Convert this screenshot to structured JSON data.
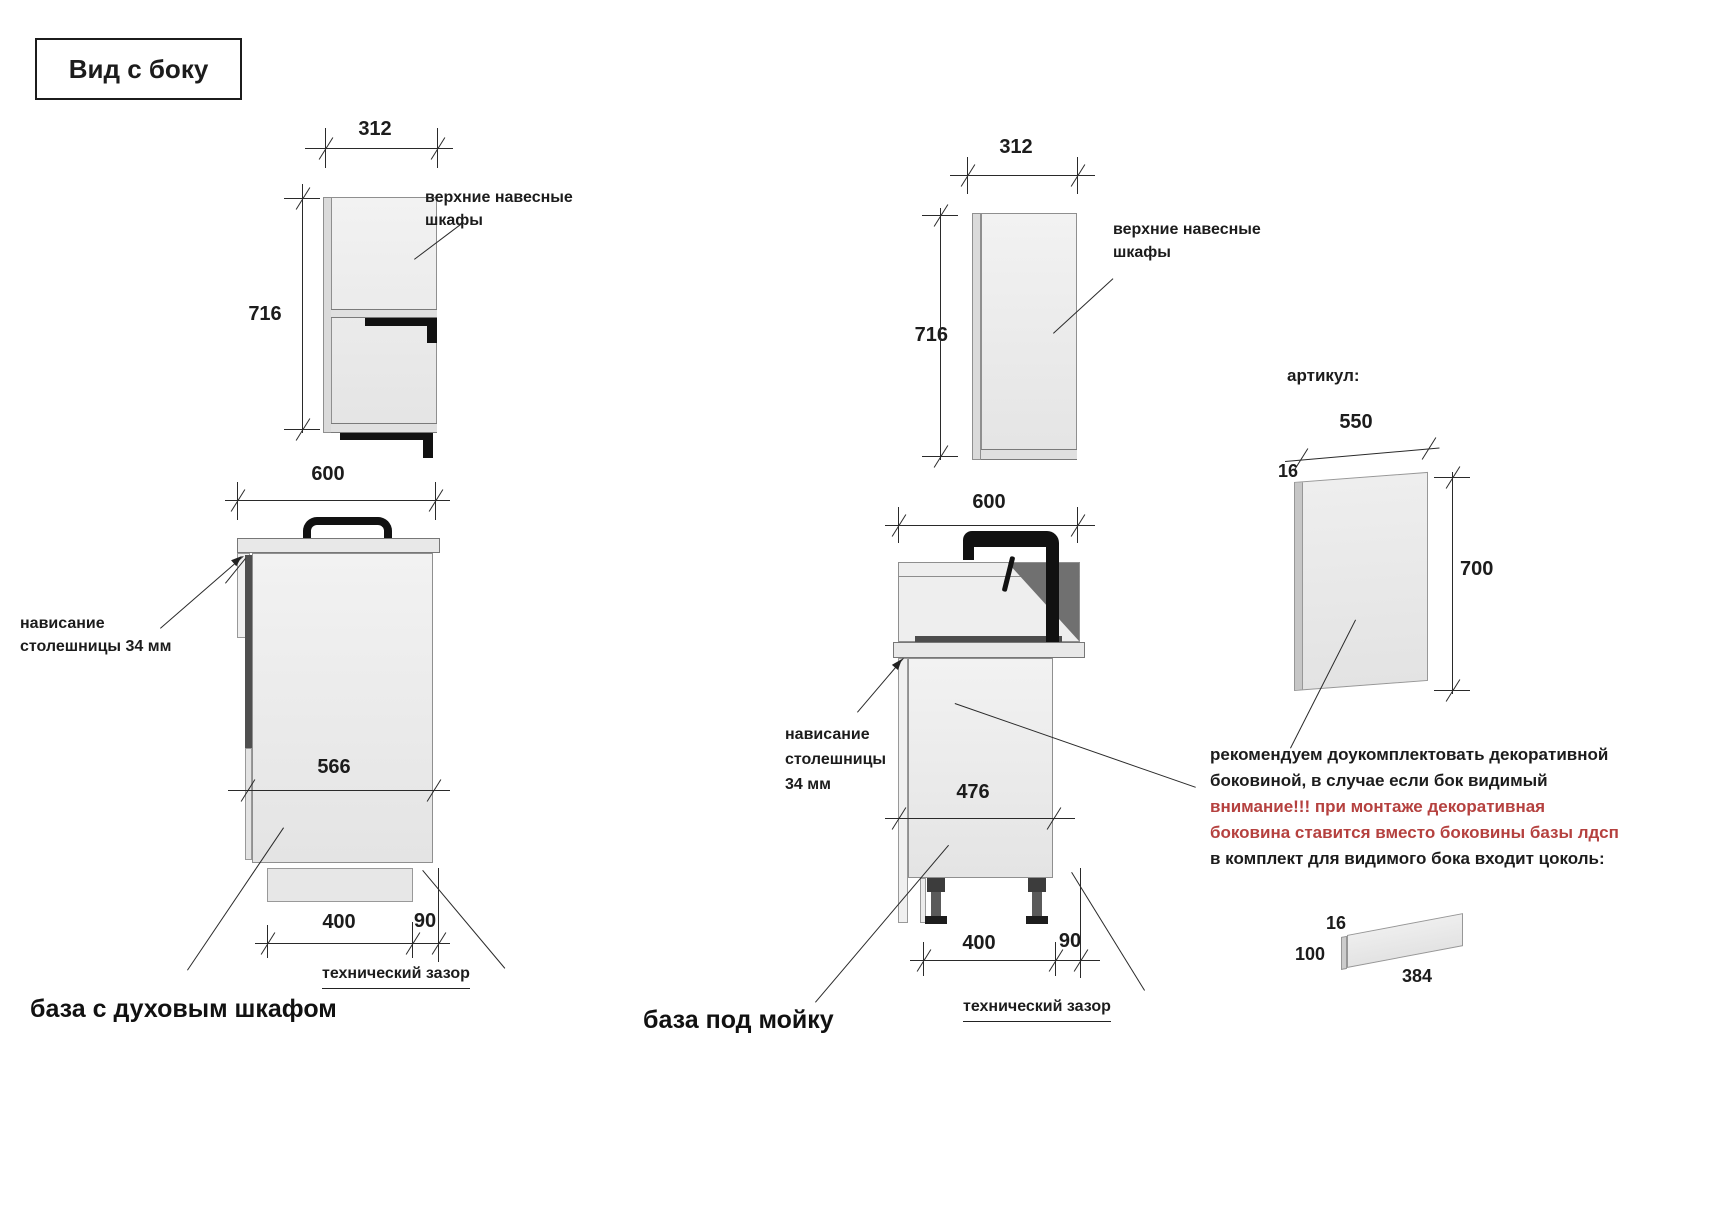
{
  "title": "Вид с боку",
  "annotations": {
    "upper_cabinets_line1": "верхние навесные",
    "upper_cabinets_line2": "шкафы",
    "overhang_line1": "нависание",
    "overhang_line2": "столешницы 34 мм",
    "overhang_mid_line1": "нависание",
    "overhang_mid_line2": "столешницы",
    "overhang_mid_line3": "34 мм",
    "tech_gap": "технический зазор",
    "articul": "артикул:"
  },
  "oven_unit": {
    "label": "база с духовым шкафом",
    "upper_width": "312",
    "upper_height": "716",
    "base_width": "600",
    "base_depth": "566",
    "plinth_depth": "400",
    "back_gap": "90"
  },
  "sink_unit": {
    "label": "база под мойку",
    "upper_width": "312",
    "upper_height": "716",
    "base_width": "600",
    "base_depth": "476",
    "plinth_depth": "400",
    "back_gap": "90"
  },
  "decor_panel": {
    "width": "550",
    "thickness": "16",
    "height": "700",
    "note_black_1": "рекомендуем доукомплектовать декоративной",
    "note_black_2": "боковиной, в случае если бок видимый",
    "note_red_1": "внимание!!! при монтаже декоративная",
    "note_red_2": "боковина ставится вместо боковины базы лдсп",
    "note_black_3": "в комплект для видимого бока входит цоколь:"
  },
  "plinth_part": {
    "thickness": "16",
    "height": "100",
    "length": "384"
  },
  "colors": {
    "warning_red": "#b5413f",
    "line_color": "#2a2a2a",
    "cabinet_fill": "#ececec",
    "dark_strip": "#4f4f4f"
  }
}
